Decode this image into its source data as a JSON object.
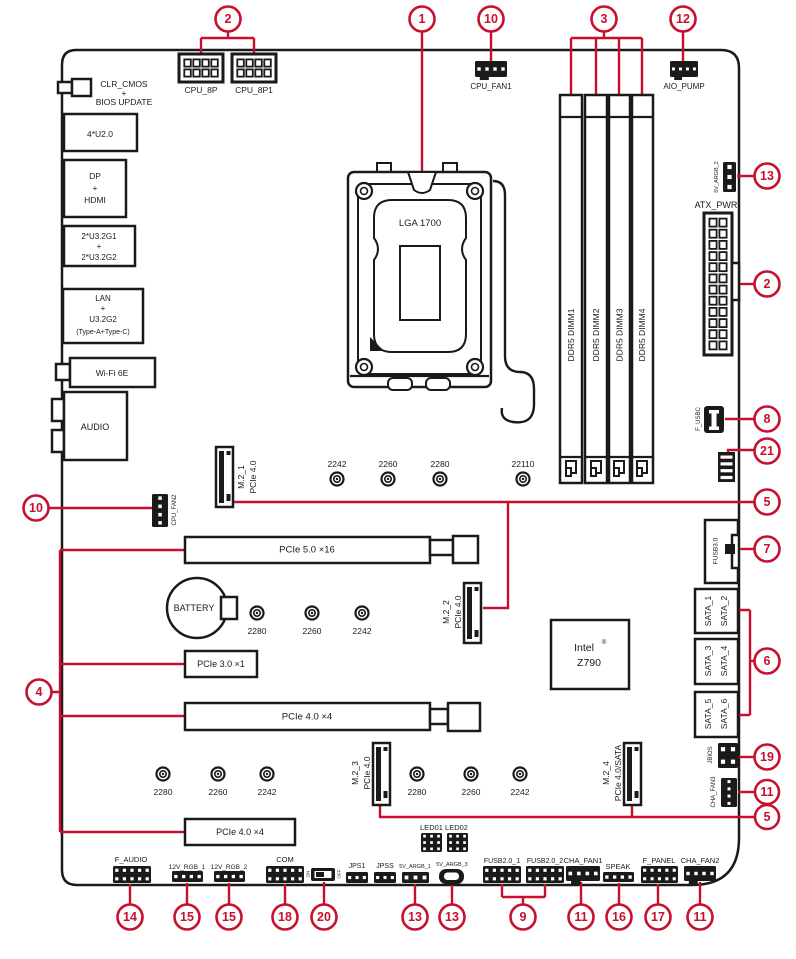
{
  "colors": {
    "accent_red": "#c8102e",
    "line_dark": "#1a1a1a",
    "background": "#ffffff"
  },
  "callouts": {
    "top": [
      "2",
      "1",
      "10",
      "3",
      "12"
    ],
    "right": [
      "13",
      "2",
      "8",
      "21",
      "5",
      "7",
      "6",
      "19",
      "11",
      "5"
    ],
    "left": [
      "10",
      "4"
    ],
    "bottom": [
      "14",
      "15",
      "15",
      "18",
      "20",
      "13",
      "13",
      "9",
      "11",
      "16",
      "17",
      "11"
    ]
  },
  "io_panel": {
    "clr_cmos_l1": "CLR_CMOS",
    "clr_cmos_l2": "+",
    "clr_cmos_l3": "BIOS UPDATE",
    "usb2": "4*U2.0",
    "dp": "DP",
    "dp_plus": "+",
    "hdmi": "HDMI",
    "usb32_l1": "2*U3.2G1",
    "usb32_plus": "+",
    "usb32_l2": "2*U3.2G2",
    "lan": "LAN",
    "lan_plus": "+",
    "lan_usb": "U3.2G2",
    "lan_type": "(Type-A+Type-C)",
    "wifi": "Wi-Fi 6E",
    "audio": "AUDIO"
  },
  "power": {
    "cpu_8p": "CPU_8P",
    "cpu_8p1": "CPU_8P1",
    "atx": "ATX_PWR"
  },
  "fans": {
    "cpu_fan1": "CPU_FAN1",
    "aio_pump": "AIO_PUMP",
    "cpu_fan2": "CPU_FAN2",
    "cha_fan1": "CHA_FAN1",
    "cha_fan2": "CHA_FAN2",
    "cha_fan3": "CHA_FAN3"
  },
  "socket": {
    "label": "LGA 1700"
  },
  "chipset": {
    "brand": "Intel",
    "reg": "®",
    "model": "Z790"
  },
  "dimm": {
    "slot1": "DDR5 DIMM1",
    "slot2": "DDR5 DIMM2",
    "slot3": "DDR5 DIMM3",
    "slot4": "DDR5 DIMM4"
  },
  "pcie": {
    "slot_5_0_x16": "PCIe 5.0 ×16",
    "slot_3_0_x1": "PCIe 3.0 ×1",
    "slot_4_0_x4_mid": "PCIe 4.0 ×4",
    "slot_4_0_x4_bottom": "PCIe 4.0 ×4"
  },
  "m2": {
    "m2_1": "M.2_1",
    "m2_1_bus": "PCIe 4.0",
    "m2_2": "M.2_2",
    "m2_2_bus": "PCIe 4.0",
    "m2_3": "M.2_3",
    "m2_3_bus": "PCIe 4.0",
    "m2_4": "M.2_4",
    "m2_4_bus": "PCIe 4.0/SATA"
  },
  "standoffs": {
    "row1": [
      "2242",
      "2260",
      "2280",
      "22110"
    ],
    "row2": [
      "2280",
      "2260",
      "2242"
    ],
    "row3": [
      "2280",
      "2260",
      "2242"
    ],
    "row4": [
      "2280",
      "2260",
      "2242"
    ]
  },
  "sata": {
    "s1": "SATA_1",
    "s2": "SATA_2",
    "s3": "SATA_3",
    "s4": "SATA_4",
    "s5": "SATA_5",
    "s6": "SATA_6"
  },
  "headers": {
    "argb2": "5V_ARGB_2",
    "f_usbc": "F_USBC",
    "fusb3": "FUSB3.0",
    "jbios": "JBIOS",
    "battery": "BATTERY",
    "f_audio": "F_AUDIO",
    "rgb1": "12V_RGB_1",
    "rgb2": "12V_RGB_2",
    "com": "COM",
    "sw_on": "ON",
    "sw_off": "OFF",
    "jps1": "JPS1",
    "jpss": "JPSS",
    "argb1": "5V_ARGB_1",
    "argb3": "5V_ARGB_3",
    "led": "LED01 LED02",
    "fusb2_1": "FUSB2.0_1",
    "fusb2_2": "FUSB2.0_2",
    "speak": "SPEAK",
    "f_panel": "F_PANEL"
  }
}
